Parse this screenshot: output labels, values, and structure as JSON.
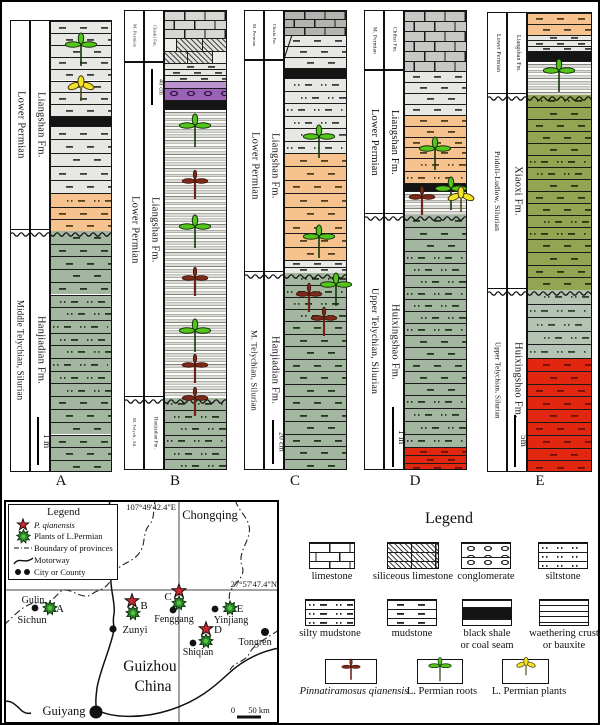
{
  "colors": {
    "orange": "#f6c28e",
    "gray": "#e7e7e3",
    "green_gray": "#a3b7a0",
    "olive_green": "#93a553",
    "pale_green_gray": "#b4c3b4",
    "red": "#e1270f",
    "purple_conglomerate": "#9a63b5",
    "purple_light": "#bb93cf",
    "limestone_light": "#d6d6d2",
    "limestone_mid": "#c7c7c3",
    "limestone_dark": "#b3b3af",
    "black_layer": "#141414",
    "symbol_dark_red": "#7c2a1a",
    "symbol_green": "#55c51e",
    "symbol_yellow": "#f2e428",
    "map_star_red": "#cf2730",
    "map_plant_green": "#2e8b2e"
  },
  "columns": [
    {
      "letter": "A",
      "x": 8,
      "label_w": 20,
      "litho_x": 48,
      "litho_w": 62,
      "top": 18,
      "bottom": 470,
      "sections": [
        {
          "age": "Lower Permian",
          "fm": "Liangshan Fm.",
          "from": 18,
          "to": 228
        },
        {
          "age": "Middle Telychian, Silurian",
          "fm": "Hanjiadian Fm.",
          "from": 228,
          "to": 470
        }
      ],
      "layers": [
        {
          "t": "gray",
          "h": 11.9,
          "n": 8
        },
        {
          "t": "black",
          "h": 9.8
        },
        {
          "t": "gray",
          "h": 13.4,
          "n": 5
        },
        {
          "t": "orangedots",
          "h": 14
        },
        {
          "t": "orange",
          "h": 12,
          "n": 2
        },
        {
          "t": "green",
          "h": 12.7,
          "n": 5
        },
        {
          "t": "greendots",
          "h": 12.7,
          "n": 8
        },
        {
          "t": "green",
          "h": 12.8,
          "n": 6
        }
      ],
      "wavy": [
        228
      ],
      "symbols": [
        {
          "s": "root",
          "x": 79,
          "y": 46
        },
        {
          "s": "plant",
          "x": 79,
          "y": 89
        }
      ],
      "scale": {
        "x": 36,
        "from": 415,
        "to": 463,
        "label": "1 m"
      },
      "letter_x": 59,
      "letter_y": 471
    },
    {
      "letter": "B",
      "x": 122,
      "label_w": 20,
      "litho_x": 162,
      "litho_w": 63,
      "top": 8,
      "bottom": 468,
      "sections": [
        {
          "age": "M. Permian",
          "fm": "Chishi Fm.",
          "from": 8,
          "to": 60
        },
        {
          "age": "Lower Permian",
          "fm": "Liangshan Fm.",
          "from": 60,
          "to": 395
        },
        {
          "age": "M. Telych., Sil.",
          "fm": "Hanjiadian Fm.",
          "from": 395,
          "to": 468
        }
      ],
      "layers": [
        {
          "t": "limeL",
          "h": 9,
          "n": 3
        },
        {
          "t": "silic",
          "h": 12.5,
          "n": 2
        },
        {
          "t": "gray",
          "h": 6,
          "n": 3
        },
        {
          "t": "purpleL",
          "h": 7
        },
        {
          "t": "conglo",
          "h": 12
        },
        {
          "t": "black",
          "h": 9
        },
        {
          "t": "ruled",
          "h": 289
        },
        {
          "t": "greendots",
          "h": 12.2,
          "n": 6
        }
      ],
      "wavy": [
        395
      ],
      "symbols": [
        {
          "s": "root",
          "x": 193,
          "y": 127
        },
        {
          "s": "pq",
          "x": 193,
          "y": 181
        },
        {
          "s": "root",
          "x": 193,
          "y": 228
        },
        {
          "s": "pq",
          "x": 193,
          "y": 278
        },
        {
          "s": "root",
          "x": 193,
          "y": 332
        },
        {
          "s": "pq",
          "x": 193,
          "y": 365
        },
        {
          "s": "pq",
          "x": 193,
          "y": 398
        }
      ],
      "scale": {
        "x": 150,
        "from": 67,
        "to": 103,
        "label": "40 cm"
      },
      "letter_x": 173,
      "letter_y": 471
    },
    {
      "letter": "C",
      "x": 242,
      "label_w": 20,
      "litho_x": 282,
      "litho_w": 63,
      "top": 8,
      "bottom": 468,
      "sections": [
        {
          "age": "M. Permian",
          "fm": "Chishi Fm.",
          "from": 8,
          "to": 58
        },
        {
          "age": "Lower Permian",
          "fm": "Liangshan Fm.",
          "from": 58,
          "to": 270
        },
        {
          "age": "M. Telychian, Silurian",
          "fm": "Hanjiadian Fm.",
          "from": 270,
          "to": 468
        }
      ],
      "diagonal": [
        282,
        57,
        290,
        33
      ],
      "layers": [
        {
          "t": "limeD",
          "h": 8,
          "n": 3
        },
        {
          "t": "gray",
          "h": 11,
          "n": 3
        },
        {
          "t": "black",
          "h": 10
        },
        {
          "t": "graydots",
          "h": 12.5,
          "n": 6
        },
        {
          "t": "orange",
          "h": 13.4,
          "n": 8
        },
        {
          "t": "gray",
          "h": 6.4,
          "n": 2
        },
        {
          "t": "greendots",
          "h": 12,
          "n": 4
        },
        {
          "t": "green",
          "h": 12.5,
          "n": 12
        }
      ],
      "wavy": [
        270
      ],
      "symbols": [
        {
          "s": "root",
          "x": 317,
          "y": 138
        },
        {
          "s": "root",
          "x": 317,
          "y": 238
        },
        {
          "s": "root",
          "x": 334,
          "y": 286
        },
        {
          "s": "pq",
          "x": 307,
          "y": 294
        },
        {
          "s": "pq",
          "x": 322,
          "y": 318
        }
      ],
      "scale": {
        "x": 271,
        "from": 418,
        "to": 462,
        "label": "20 cm"
      },
      "letter_x": 293,
      "letter_y": 471
    },
    {
      "letter": "D",
      "x": 362,
      "label_w": 20,
      "litho_x": 402,
      "litho_w": 63,
      "top": 8,
      "bottom": 468,
      "sections": [
        {
          "age": "M. Permian",
          "fm": "Chihsi Fm.",
          "from": 8,
          "to": 68
        },
        {
          "age": "Lower Permian",
          "fm": "Liangshan Fm.",
          "from": 68,
          "to": 212
        },
        {
          "age": "Upper Telychian, Silurian",
          "fm": "Huixingshao Fm.",
          "from": 212,
          "to": 468
        }
      ],
      "layers": [
        {
          "t": "limeM",
          "h": 10,
          "n": 6
        },
        {
          "t": "gray",
          "h": 11,
          "n": 4
        },
        {
          "t": "orange",
          "h": 10.75,
          "n": 4
        },
        {
          "t": "orangedots",
          "h": 12.5,
          "n": 2
        },
        {
          "t": "black",
          "h": 8
        },
        {
          "t": "ruled",
          "h": 24
        },
        {
          "t": "green",
          "h": 12,
          "n": 3
        },
        {
          "t": "greendots",
          "h": 12,
          "n": 7
        },
        {
          "t": "green",
          "h": 12,
          "n": 5
        },
        {
          "t": "greendots",
          "h": 13,
          "n": 4
        },
        {
          "t": "red",
          "h": 8,
          "n": 3
        }
      ],
      "wavy": [
        212
      ],
      "symbols": [
        {
          "s": "root",
          "x": 433,
          "y": 150
        },
        {
          "s": "root",
          "x": 449,
          "y": 190
        },
        {
          "s": "pq",
          "x": 420,
          "y": 197
        },
        {
          "s": "plant",
          "x": 459,
          "y": 200
        }
      ],
      "scale": {
        "x": 391,
        "from": 405,
        "to": 465,
        "label": "1 m"
      },
      "letter_x": 413,
      "letter_y": 471
    },
    {
      "letter": "E",
      "x": 485,
      "label_w": 20,
      "litho_x": 525,
      "litho_w": 65,
      "top": 10,
      "bottom": 470,
      "sections": [
        {
          "age": "Lower Permian",
          "fm": "Liangshan Fm.",
          "from": 10,
          "to": 92
        },
        {
          "age": "Pridoli-Ludlow, Silurian",
          "fm": "Xiaoxi Fm.",
          "from": 92,
          "to": 287
        },
        {
          "age": "Upper Telychian, Silurian",
          "fm": "Huixingshao Fm.",
          "from": 287,
          "to": 470
        }
      ],
      "layers": [
        {
          "t": "orange",
          "h": 11,
          "n": 2
        },
        {
          "t": "gray",
          "h": 5.3,
          "n": 3
        },
        {
          "t": "black",
          "h": 10.1
        },
        {
          "t": "ruled",
          "h": 34
        },
        {
          "t": "olivedots",
          "h": 12
        },
        {
          "t": "olive",
          "h": 12,
          "n": 4
        },
        {
          "t": "olivedots",
          "h": 12,
          "n": 2
        },
        {
          "t": "olive",
          "h": 12,
          "n": 3
        },
        {
          "t": "olivedots",
          "h": 12,
          "n": 2
        },
        {
          "t": "olive",
          "h": 12.75,
          "n": 4
        },
        {
          "t": "graygreen",
          "h": 13.6,
          "n": 5
        },
        {
          "t": "red",
          "h": 12.8,
          "n": 9
        }
      ],
      "wavy": [
        92,
        287
      ],
      "symbols": [
        {
          "s": "root",
          "x": 557,
          "y": 72
        }
      ],
      "scale": {
        "x": 513,
        "from": 413,
        "to": 465,
        "label": "5m"
      },
      "letter_x": 538,
      "letter_y": 471
    }
  ],
  "map": {
    "legend": {
      "title": "Legend",
      "items": [
        {
          "icon": "star-icon",
          "label": "P. qianensis",
          "italic": true
        },
        {
          "icon": "plant-icon",
          "label": "Plants of L.Permian"
        },
        {
          "icon": "boundary-icon",
          "label": "Boundary of provinces"
        },
        {
          "icon": "motorway-icon",
          "label": "Motorway"
        },
        {
          "icon": "city-icon",
          "label": "City or County"
        }
      ]
    },
    "grid": {
      "lon_x": 177,
      "lat_y": 588,
      "lon_label": "107°49'42.4\"E",
      "lat_label": "27°57'47.4\"N"
    },
    "region_labels": [
      {
        "text": "Chongqing",
        "x": 208,
        "y": 517,
        "size": 12.5
      },
      {
        "text": "Sichun",
        "x": 30,
        "y": 621,
        "size": 10.5
      },
      {
        "text": "Guizhou",
        "x": 148,
        "y": 669,
        "size": 15.5
      },
      {
        "text": "China",
        "x": 151,
        "y": 689,
        "size": 15.5
      }
    ],
    "cities": [
      {
        "name": "Gulin",
        "cx": 33,
        "cy": 606,
        "r": 3.4,
        "tx": 31,
        "ty": 601,
        "size": 10
      },
      {
        "name": "Zunyi",
        "cx": 111,
        "cy": 627,
        "r": 3.6,
        "tx": 133,
        "ty": 631,
        "size": 10.5
      },
      {
        "name": "Fenggang",
        "cx": 171,
        "cy": 608,
        "r": 3.4,
        "tx": 172,
        "ty": 620,
        "size": 10
      },
      {
        "name": "Yinjiang",
        "cx": 213,
        "cy": 607,
        "r": 3.4,
        "tx": 229,
        "ty": 621,
        "size": 10
      },
      {
        "name": "Shiqian",
        "cx": 191,
        "cy": 641,
        "r": 3.4,
        "tx": 196,
        "ty": 653,
        "size": 10
      },
      {
        "name": "Tongren",
        "cx": 263,
        "cy": 630,
        "r": 4,
        "tx": 253,
        "ty": 643,
        "size": 10
      },
      {
        "name": "Guiyang",
        "cx": 94,
        "cy": 710,
        "r": 6.5,
        "tx": 62,
        "ty": 713,
        "size": 12.5
      }
    ],
    "sites": [
      {
        "id": "A",
        "plant": [
          48,
          606
        ],
        "label": [
          58,
          610
        ]
      },
      {
        "id": "B",
        "star": [
          130,
          599
        ],
        "plant": [
          131,
          611
        ],
        "label": [
          142,
          607
        ]
      },
      {
        "id": "C",
        "star": [
          177,
          589
        ],
        "plant": [
          177,
          601
        ],
        "label": [
          166,
          598
        ]
      },
      {
        "id": "D",
        "star": [
          204,
          627
        ],
        "plant": [
          204,
          639
        ],
        "label": [
          216,
          631
        ]
      },
      {
        "id": "E",
        "plant": [
          228,
          606
        ],
        "label": [
          238,
          610
        ]
      }
    ],
    "scalebar": {
      "zero": "0",
      "label": "50 km",
      "x1": 235,
      "x2": 259,
      "y": 715
    }
  },
  "legend": {
    "title": "Legend",
    "items": [
      {
        "label": "limestone",
        "x": 307,
        "y": 540,
        "w": 46,
        "h": 27,
        "layers": [
          {
            "t": "limeW",
            "h": 9,
            "n": 3
          }
        ],
        "lx": 330
      },
      {
        "label": "siliceous limestone",
        "x": 385,
        "y": 540,
        "w": 52,
        "h": 27,
        "layers": [
          {
            "t": "silicW",
            "h": 9,
            "n": 3
          }
        ],
        "lx": 411
      },
      {
        "label": "conglomerate",
        "x": 459,
        "y": 540,
        "w": 50,
        "h": 27,
        "layers": [
          {
            "t": "congloW",
            "h": 13.5,
            "n": 2
          }
        ],
        "lx": 484
      },
      {
        "label": "siltstone",
        "x": 536,
        "y": 540,
        "w": 50,
        "h": 27,
        "layers": [
          {
            "t": "siltW",
            "h": 9,
            "n": 3
          }
        ],
        "lx": 561
      },
      {
        "label": "silty mudstone",
        "x": 303,
        "y": 597,
        "w": 50,
        "h": 27,
        "layers": [
          {
            "t": "siltymudW",
            "h": 9,
            "n": 3
          }
        ],
        "lx": 328
      },
      {
        "label": "mudstone",
        "x": 385,
        "y": 597,
        "w": 50,
        "h": 27,
        "layers": [
          {
            "t": "mudW",
            "h": 9,
            "n": 3
          }
        ],
        "lx": 410
      },
      {
        "label": "black shale\nor coal seam",
        "x": 460,
        "y": 597,
        "w": 50,
        "h": 27,
        "layers": [
          {
            "t": "whiteL",
            "h": 7
          },
          {
            "t": "blackL",
            "h": 12
          },
          {
            "t": "whiteL",
            "h": 8
          }
        ],
        "lx": 485
      },
      {
        "label": "waethering crust\nor bauxite",
        "x": 537,
        "y": 597,
        "w": 50,
        "h": 27,
        "layers": [
          {
            "t": "whiteL",
            "h": 5.4,
            "n": 5
          }
        ],
        "lx": 562
      },
      {
        "label": "Pinnatiramosus qianensis",
        "italic": true,
        "sym": "pq",
        "x": 323,
        "y": 657,
        "w": 52,
        "h": 25,
        "lx": 352
      },
      {
        "label": "L. Permian roots",
        "sym": "root",
        "x": 415,
        "y": 657,
        "w": 46,
        "h": 25,
        "lx": 440
      },
      {
        "label": "L. Permian plants",
        "sym": "plant",
        "x": 500,
        "y": 657,
        "w": 47,
        "h": 25,
        "lx": 527
      }
    ]
  }
}
